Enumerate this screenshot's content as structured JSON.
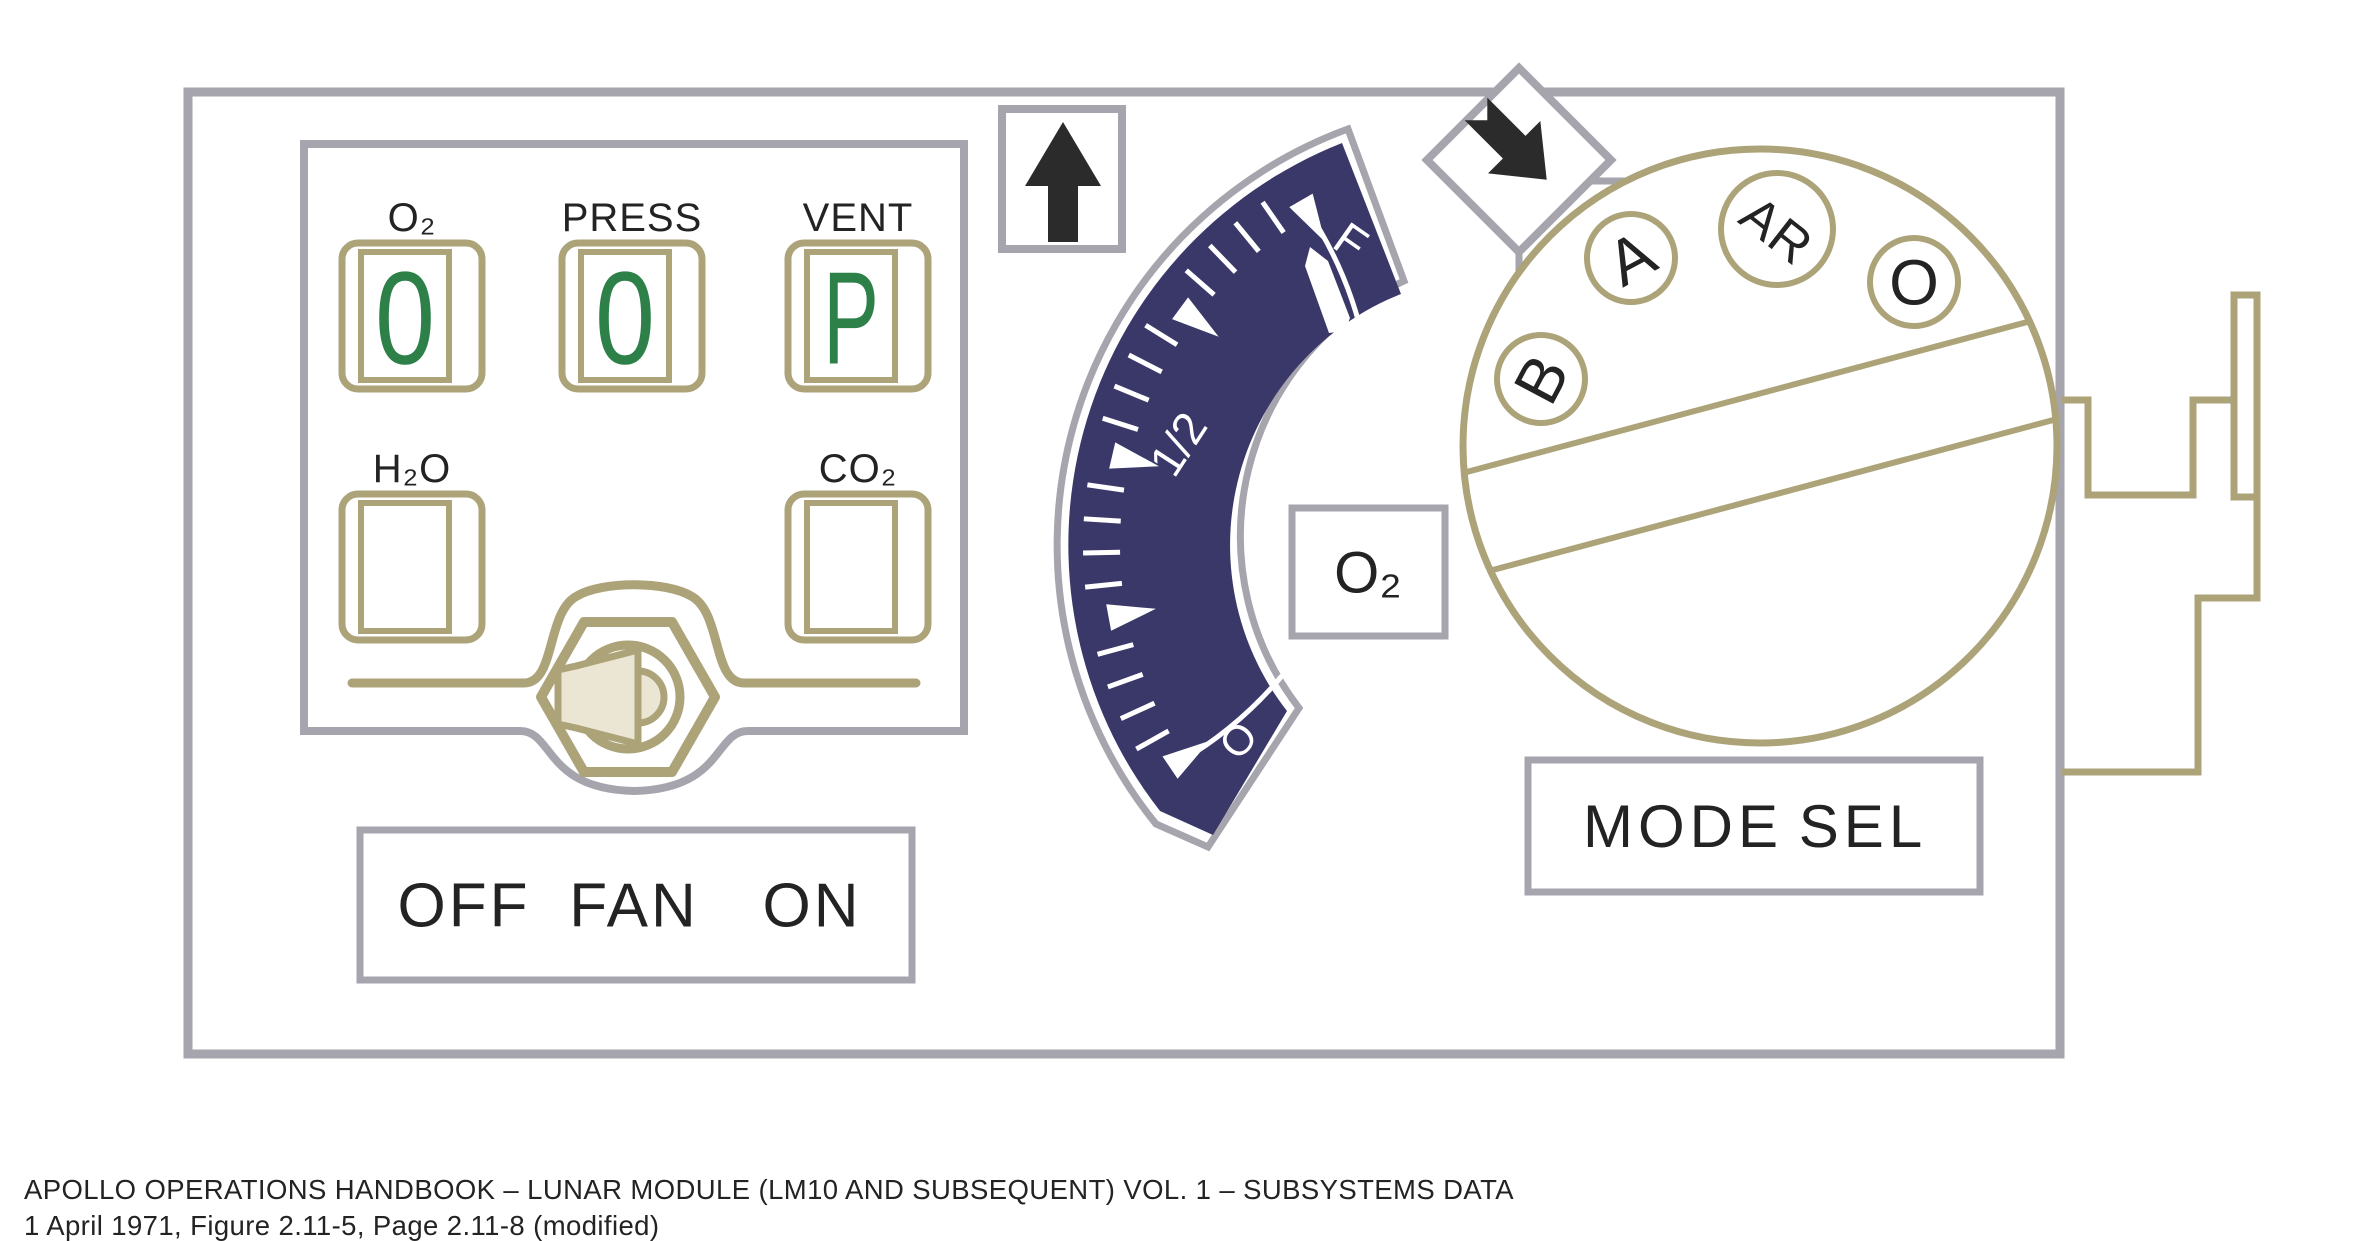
{
  "colors": {
    "panel_border": "#a6a5ad",
    "olive": "#aca379",
    "navy": "#3a3869",
    "green_digit": "#2e8049",
    "beige_speaker": "#eae6d3",
    "ink": "#232323"
  },
  "indicator_panel": {
    "indicators": [
      {
        "label": "O₂",
        "value": "0"
      },
      {
        "label": "PRESS",
        "value": "0"
      },
      {
        "label": "VENT",
        "value": "P"
      },
      {
        "label": "H₂O",
        "value": ""
      },
      {
        "label": "CO₂",
        "value": ""
      }
    ]
  },
  "fan_switch": {
    "labels": [
      "OFF",
      "FAN",
      "ON"
    ]
  },
  "o2_gauge": {
    "tag": "O₂",
    "scale_labels": {
      "full": "F",
      "half": "1/2",
      "empty": "O"
    },
    "major_angles_deg": [
      146,
      169.5,
      193,
      216.5,
      240
    ],
    "minor_ticks_per_interval": 4,
    "needle_angle_deg": 237
  },
  "mode_selector": {
    "positions": [
      "B",
      "A",
      "AR",
      "O"
    ],
    "label_words": [
      "MODE",
      "SEL"
    ]
  },
  "caption": {
    "line1": "APOLLO OPERATIONS HANDBOOK – LUNAR MODULE (LM10 AND SUBSEQUENT) VOL. 1 – SUBSYSTEMS DATA",
    "line2": "1 April 1971, Figure 2.11-5, Page 2.11-8 (modified)"
  }
}
